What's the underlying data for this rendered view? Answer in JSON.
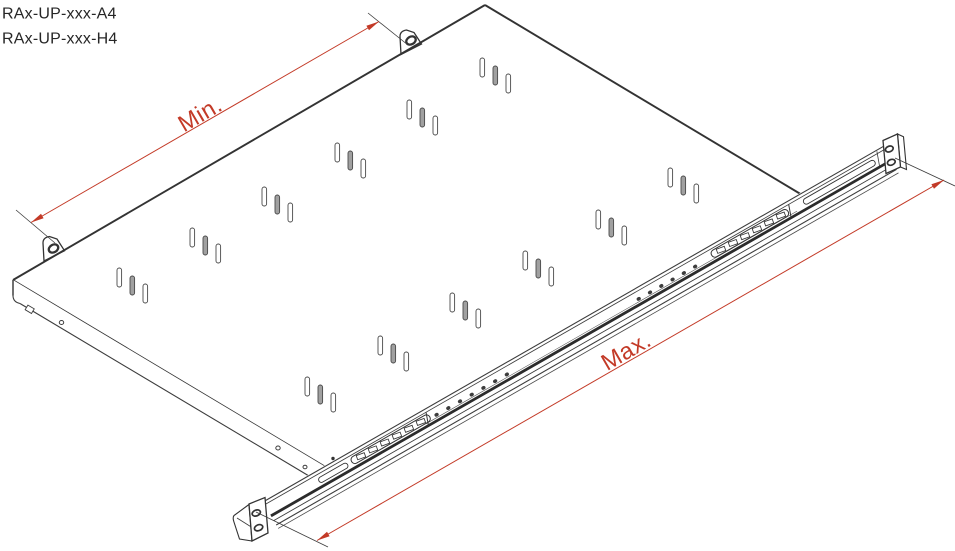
{
  "header": {
    "model_line1": "RAx-UP-xxx-A4",
    "model_line2": "RAx-UP-xxx-H4"
  },
  "dimensions": {
    "min_label": "Min.",
    "max_label": "Max."
  },
  "drawing": {
    "subject": "rack shelf with adjustable telescopic mounting rail",
    "colors": {
      "background": "#ffffff",
      "line_dark": "#333333",
      "dimension_red": "#c33a27",
      "slot_gray": "#a0a0a0"
    }
  }
}
